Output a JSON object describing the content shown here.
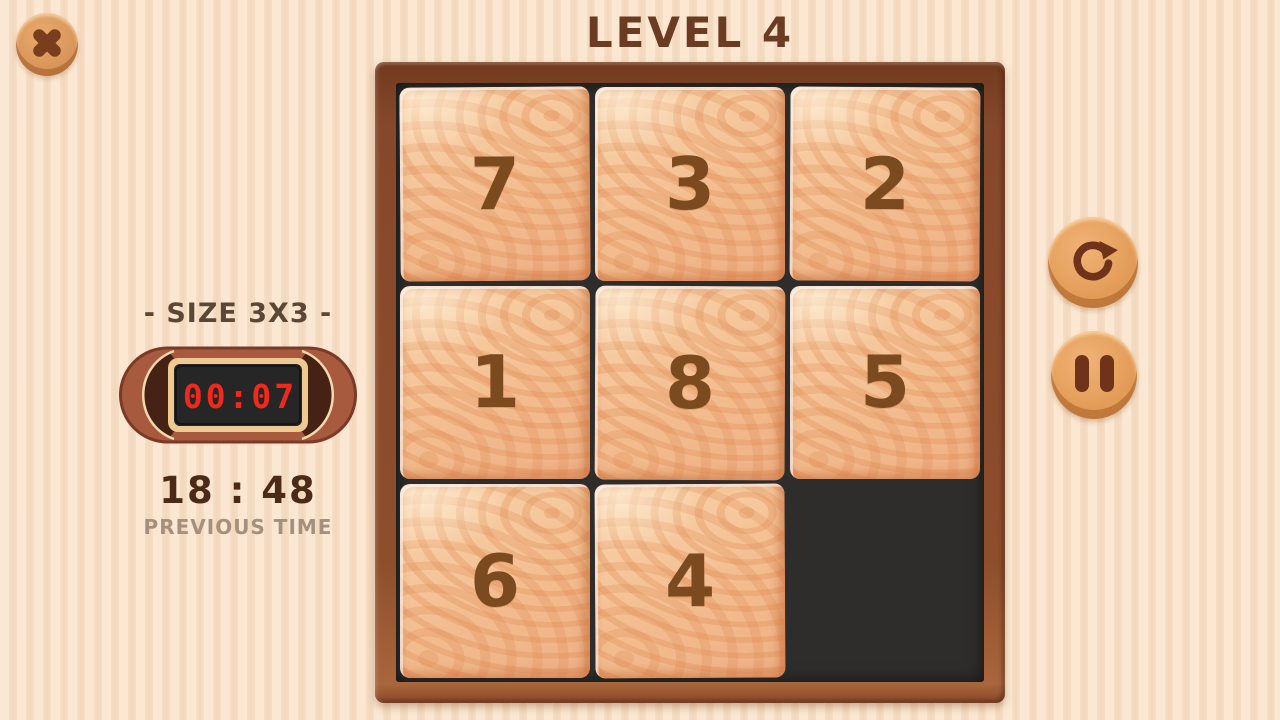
{
  "title": "LEVEL 4",
  "left_panel": {
    "size_label": "- SIZE 3X3 -",
    "timer_value": "00:07",
    "previous_time_value": "18 : 48",
    "previous_time_label": "PREVIOUS TIME"
  },
  "board": {
    "size": "3x3",
    "tiles": [
      "7",
      "3",
      "2",
      "1",
      "8",
      "5",
      "6",
      "4",
      ""
    ]
  },
  "controls": {
    "close_icon": "close-x",
    "restart_icon": "circular-arrow-clockwise",
    "pause_icon": "double-bars"
  },
  "colors": {
    "timer_digits": "#f1281a",
    "tile_number": "#7c4a1f",
    "title_text": "#6b3c22",
    "board_frame": "#8d4e2c",
    "empty_cell": "#2e2d2b",
    "bg_stripe_light": "#fbe7d2",
    "bg_stripe_dark": "#f2d8bd"
  }
}
